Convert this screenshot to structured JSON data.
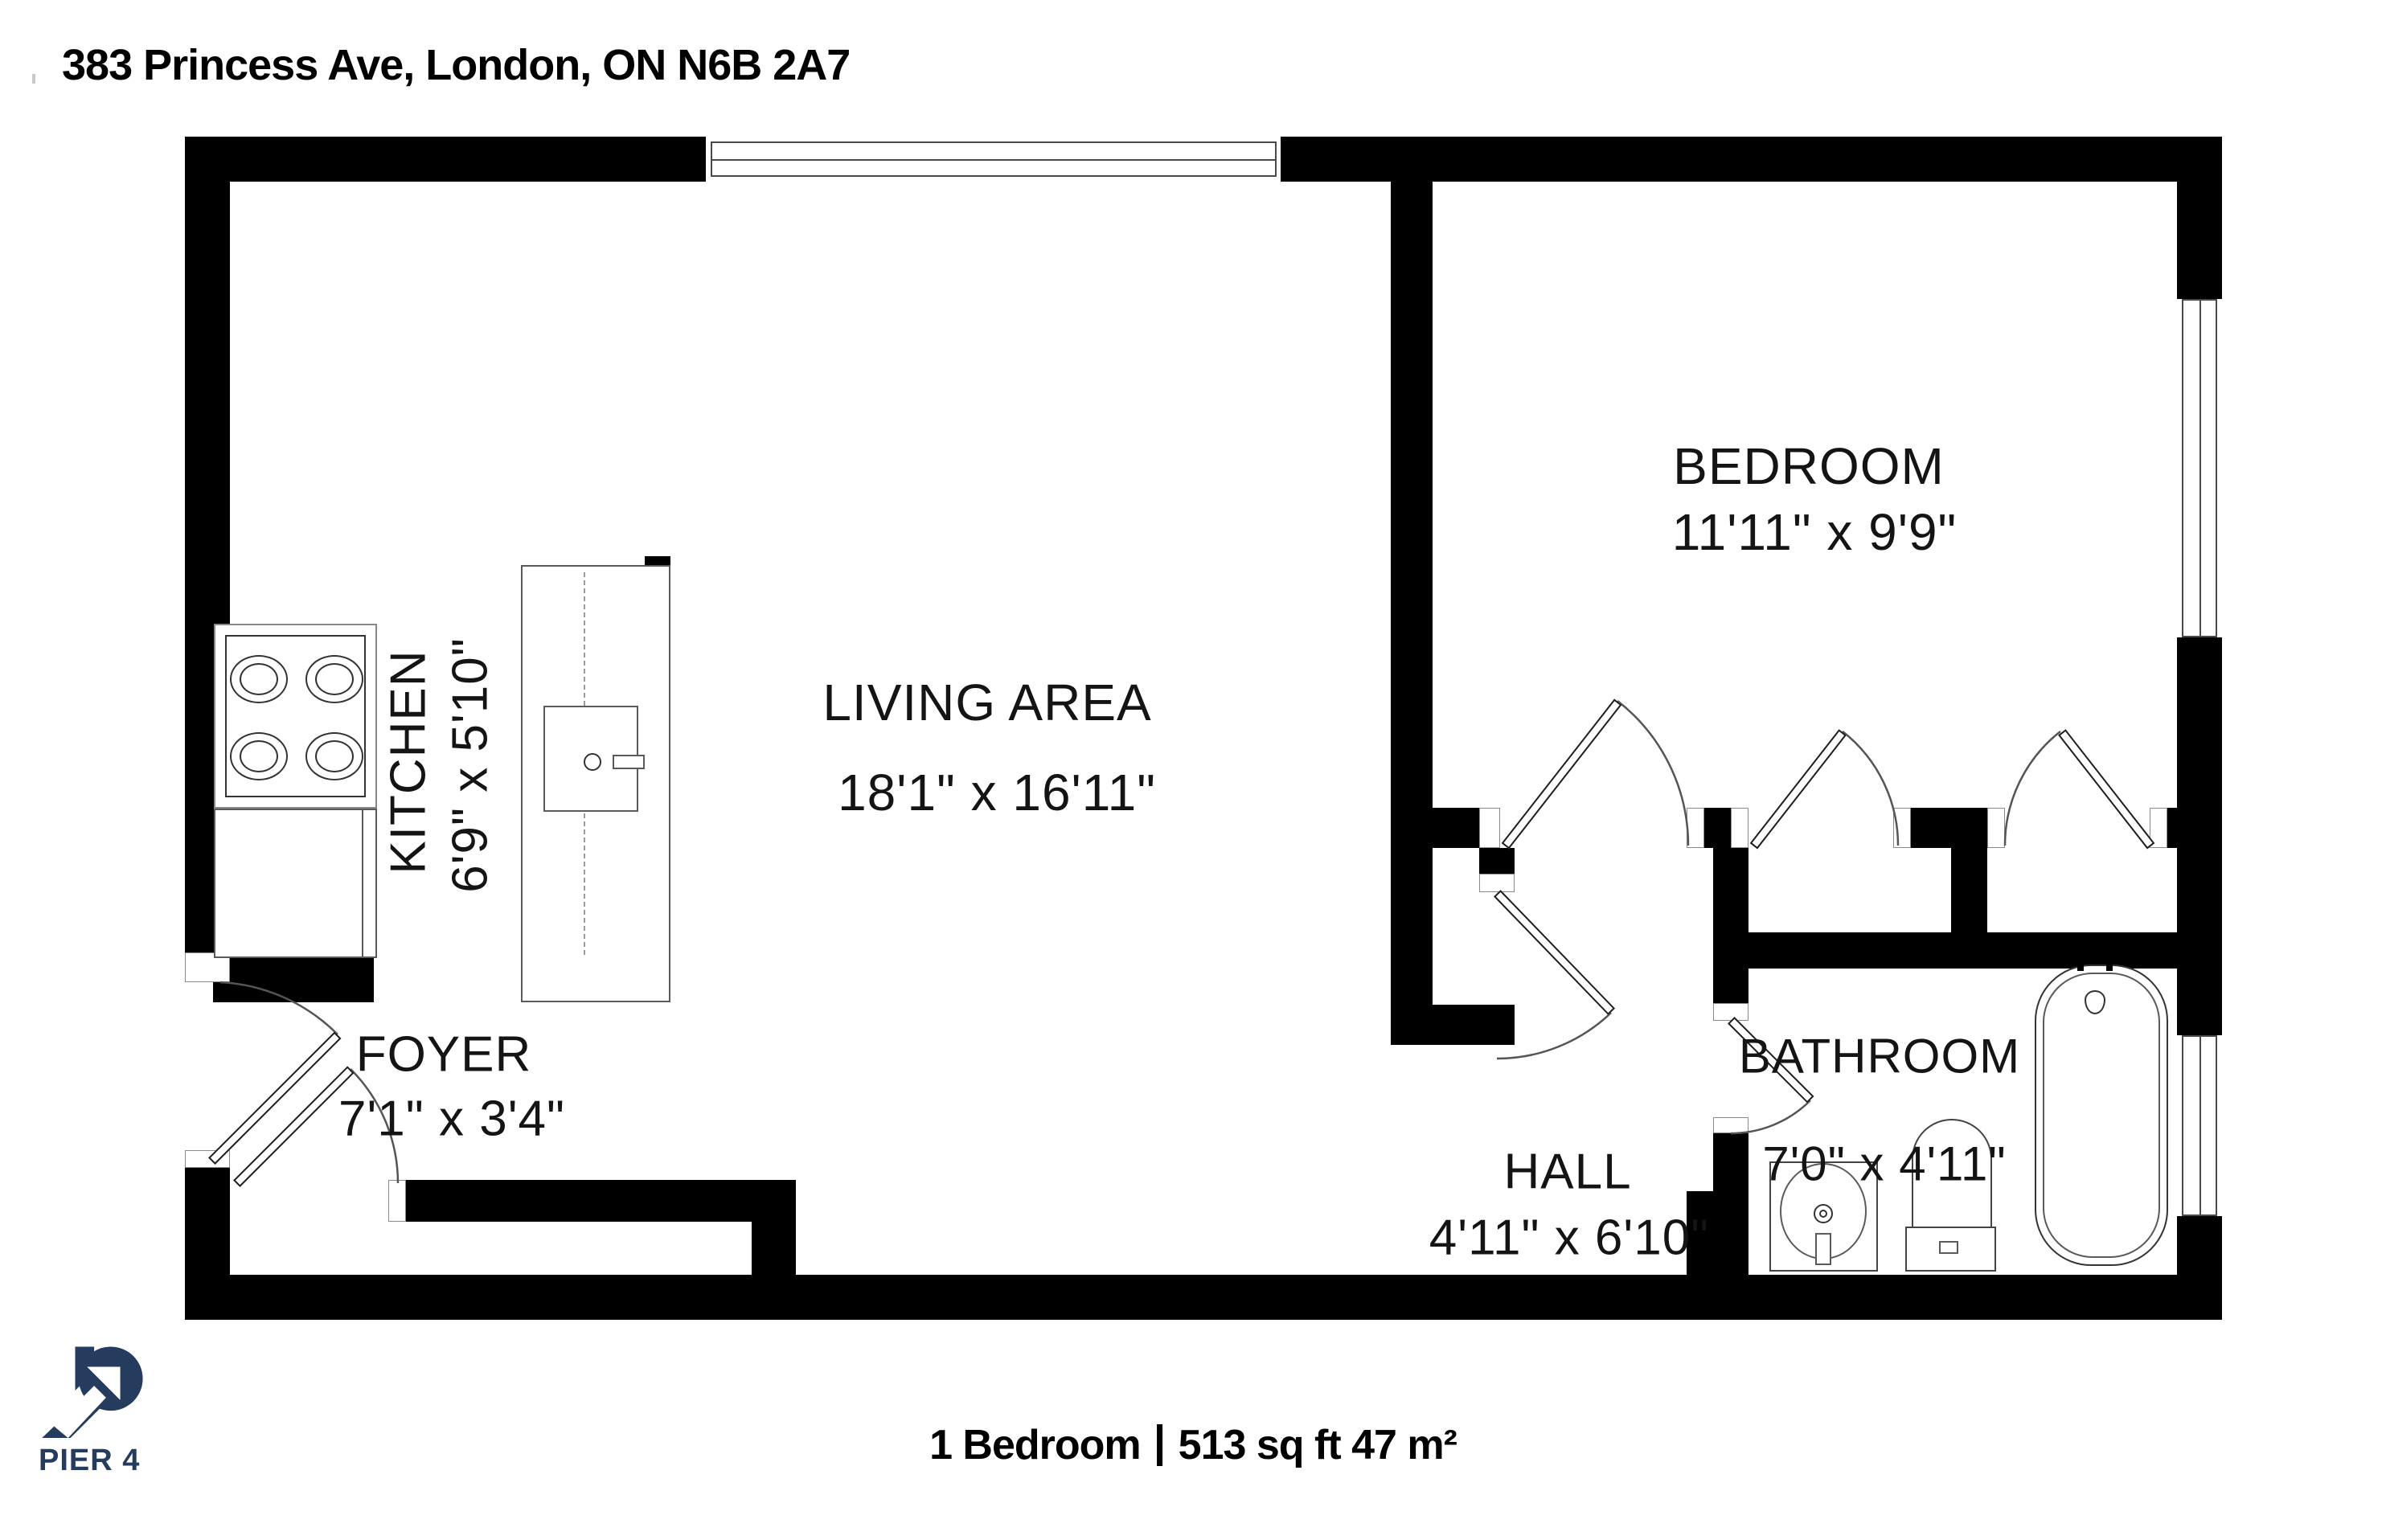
{
  "title": "383 Princess Ave, London, ON N6B 2A7",
  "rooms": {
    "kitchen": {
      "name": "KITCHEN",
      "dims": "6'9\" x 5'10\""
    },
    "living": {
      "name": "LIVING AREA",
      "dims": "18'1\" x 16'11\""
    },
    "bedroom": {
      "name": "BEDROOM",
      "dims": "11'11\" x 9'9\""
    },
    "foyer": {
      "name": "FOYER",
      "dims": "7'1\" x 3'4\""
    },
    "hall": {
      "name": "HALL",
      "dims": "4'11\" x 6'10\""
    },
    "bathroom": {
      "name": "BATHROOM",
      "dims": "7'0\" x 4'11\""
    }
  },
  "footer": {
    "left": "1 Bedroom",
    "separator": "|",
    "right": "513 sq ft 47 m²"
  },
  "logo": {
    "text": "PIER 4",
    "color": "#253c5f"
  },
  "colors": {
    "wall": "#000000",
    "line": "#555555",
    "background": "#ffffff"
  }
}
